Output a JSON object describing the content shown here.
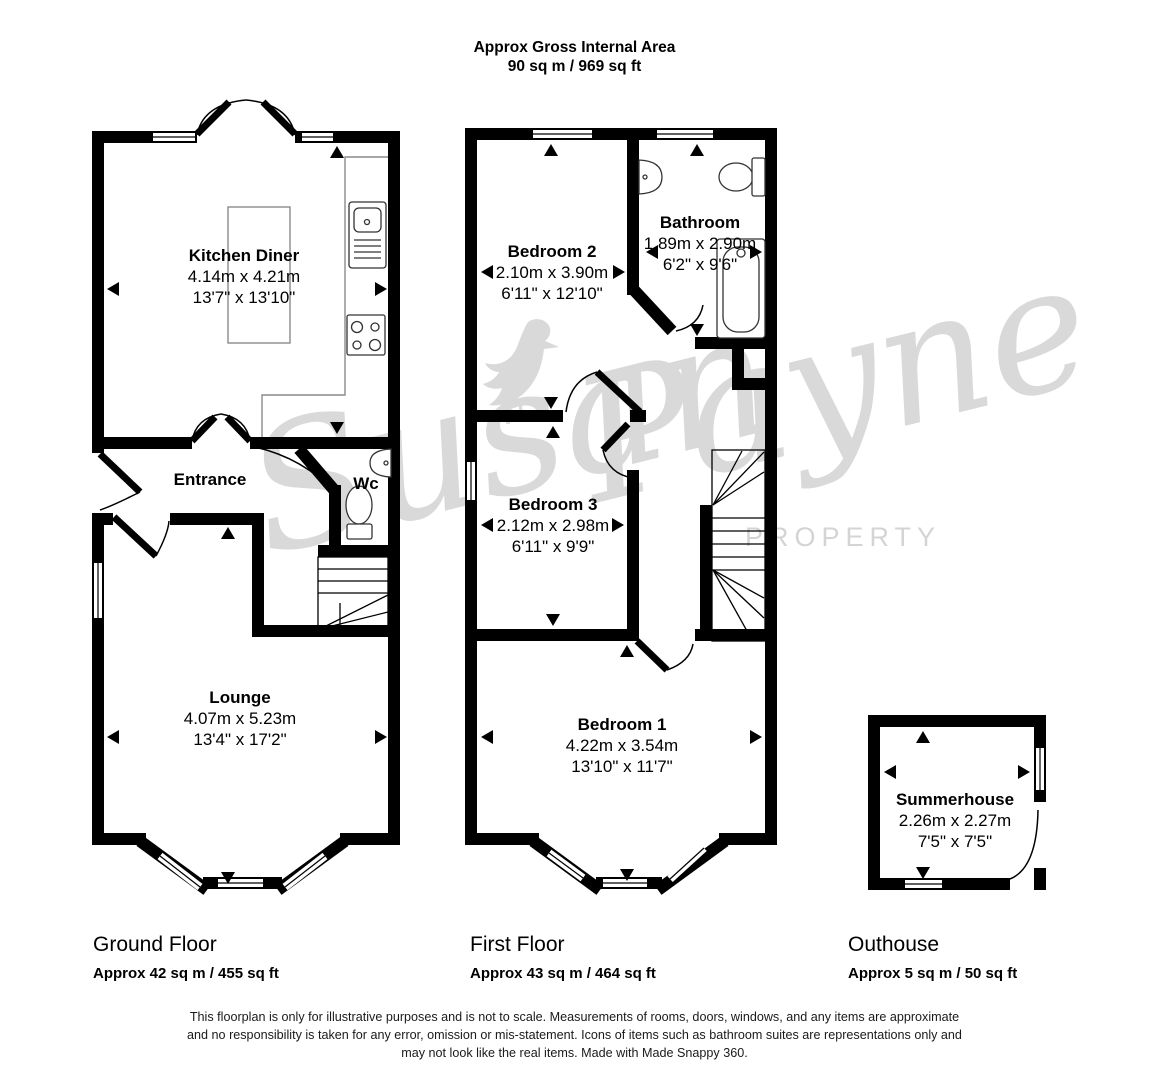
{
  "header": {
    "line1": "Approx Gross Internal Area",
    "line2": "90 sq m / 969 sq ft"
  },
  "rooms": {
    "kitchen": {
      "name": "Kitchen Diner",
      "metric": "4.14m x 4.21m",
      "imperial": "13'7\" x 13'10\""
    },
    "entrance": {
      "name": "Entrance"
    },
    "wc": {
      "name": "Wc"
    },
    "lounge": {
      "name": "Lounge",
      "metric": "4.07m x 5.23m",
      "imperial": "13'4\" x 17'2\""
    },
    "bedroom2": {
      "name": "Bedroom 2",
      "metric": "2.10m x 3.90m",
      "imperial": "6'11\" x 12'10\""
    },
    "bathroom": {
      "name": "Bathroom",
      "metric": "1.89m x 2.90m",
      "imperial": "6'2\" x 9'6\""
    },
    "bedroom3": {
      "name": "Bedroom 3",
      "metric": "2.12m x 2.98m",
      "imperial": "6'11\" x 9'9\""
    },
    "bedroom1": {
      "name": "Bedroom 1",
      "metric": "4.22m x 3.54m",
      "imperial": "13'10\" x 11'7\""
    },
    "summerhouse": {
      "name": "Summerhouse",
      "metric": "2.26m x 2.27m",
      "imperial": "7'5\" x 7'5\""
    }
  },
  "floors": [
    {
      "label": "Ground Floor",
      "area": "Approx 42 sq m / 455 sq ft"
    },
    {
      "label": "First Floor",
      "area": "Approx 43 sq m / 464 sq ft"
    },
    {
      "label": "Outhouse",
      "area": "Approx 5 sq m / 50 sq ft"
    }
  ],
  "watermark": {
    "script_first": "Susan",
    "script_second": "Payne",
    "subtext": "PROPERTY"
  },
  "disclaimer": [
    "This floorplan is only for illustrative purposes and is not to scale. Measurements of rooms, doors, windows, and any items are approximate",
    "and no responsibility is taken for any error, omission or mis-statement. Icons of items such as bathroom suites are representations only and",
    "may not look like the real items. Made with Made Snappy 360."
  ],
  "colors": {
    "wall": "#000000",
    "floor": "#ffffff",
    "watermark": "#d9d9d9",
    "fixture": "#333333",
    "counter": "#8a8a8a"
  }
}
